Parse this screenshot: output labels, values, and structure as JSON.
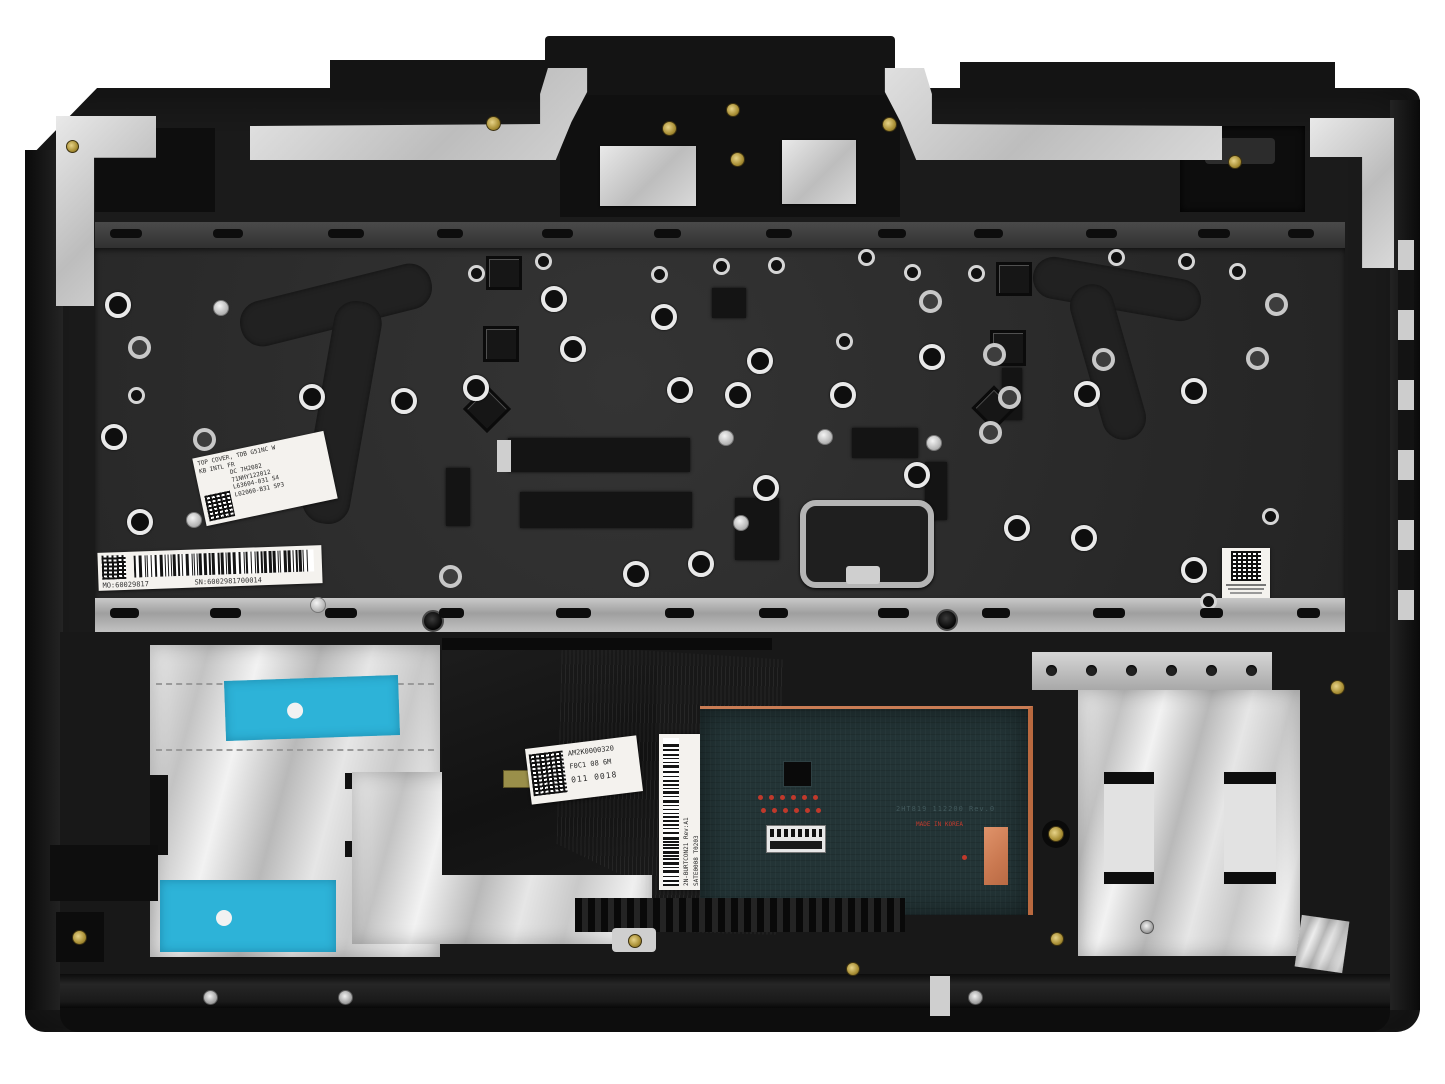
{
  "photo": {
    "subject": "laptop-palmrest-top-cover-internal-view",
    "background_color": "#ffffff"
  },
  "colors": {
    "body": "#1a1a1a",
    "keyboard_plate": "#2b2b2b",
    "foil_silver": "#d8d8d8",
    "adhesive_pad_blue": "#2db3d8",
    "touchpad_pcb": "#233436",
    "copper": "#c97c54",
    "brass_screw": "#b89a3e",
    "label_paper": "#f4f2ee",
    "test_point_red": "#c0392b"
  },
  "labels": {
    "spec_label": {
      "lines": [
        "TOP COVER, TDB G51NC W",
        "KB INTL FR",
        "DC 7H2082",
        "71NHY122012",
        "L63604-031 S4",
        "L02060-B31 SP3"
      ]
    },
    "mo_sn_label": {
      "mo": "MO:60029817",
      "sn": "SN:6002981700014"
    },
    "cable_label": {
      "lines": [
        "AM2K0000320",
        "F0C1 08 6M",
        "011 0018"
      ]
    },
    "vertical_label": {
      "lines": [
        "2N-BURTCON21 Rev:A1",
        "SATE0008 T0203",
        "P/N:PK1DHQB14"
      ]
    },
    "touchpad": {
      "pcb_text": "2HT819 112200 Rev.0",
      "origin_text": "MADE IN KOREA"
    }
  }
}
